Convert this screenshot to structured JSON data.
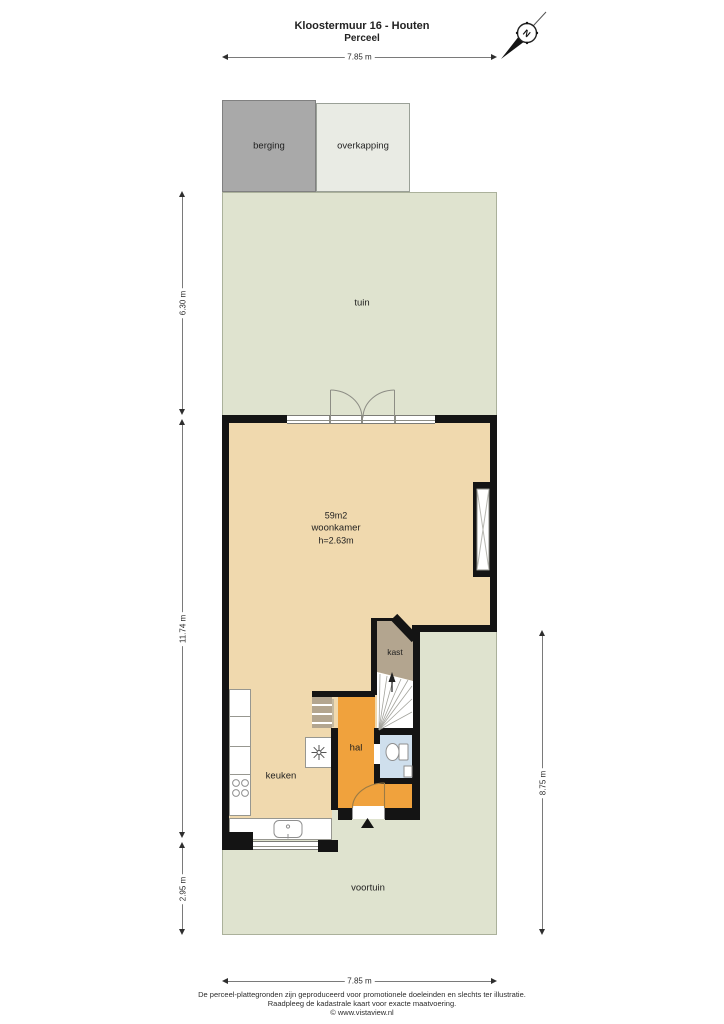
{
  "title": {
    "address": "Kloostermuur 16 - Houten",
    "subtitle": "Perceel"
  },
  "compass": {
    "label": "N"
  },
  "dimensions": {
    "top": "7.85 m",
    "bottom": "7.85 m",
    "left_tuin": "6.30 m",
    "left_house": "11.74 m",
    "left_voortuin": "2.95 m",
    "right_side": "8.75 m"
  },
  "rooms": {
    "berging": {
      "label": "berging"
    },
    "overkapping": {
      "label": "overkapping"
    },
    "tuin": {
      "label": "tuin"
    },
    "woonkamer": {
      "area": "59m2",
      "label": "woonkamer",
      "height": "h=2.63m"
    },
    "kast": {
      "label": "kast"
    },
    "hal": {
      "label": "hal"
    },
    "keuken": {
      "label": "keuken"
    },
    "voortuin": {
      "label": "voortuin"
    }
  },
  "colors": {
    "garden": "#dfe3cf",
    "floor": "#f0d9ae",
    "hall_accent": "#f0a23d",
    "closet": "#b3a58f",
    "toilet": "#cfdfed",
    "wall": "#141414",
    "shed": "#a9a9a9",
    "canopy": "#e9ebe4"
  },
  "footer": {
    "line1": "De perceel-plattegronden zijn geproduceerd voor promotionele doeleinden en slechts ter illustratie.",
    "line2": "Raadpleeg de kadastrale kaart voor exacte maatvoering.",
    "line3": "© www.vistaview.nl"
  }
}
